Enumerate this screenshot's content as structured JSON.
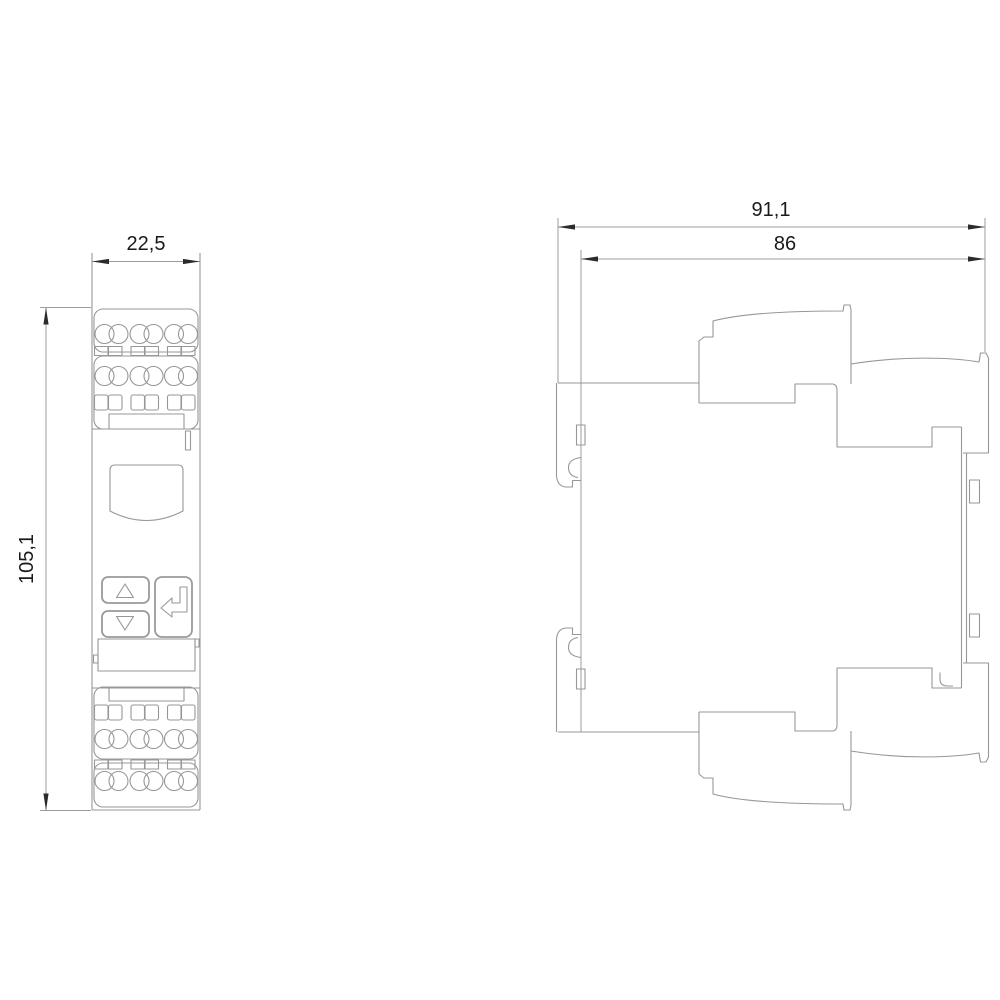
{
  "drawing": {
    "type": "technical-dimension-drawing",
    "background": "#ffffff"
  },
  "dimensions": {
    "front_width": "22,5",
    "front_height": "105,1",
    "side_depth_total": "91,1",
    "side_depth_body": "86"
  },
  "views": [
    {
      "id": "front-view",
      "dimension_labels": [
        "22,5",
        "105,1"
      ]
    },
    {
      "id": "side-view",
      "dimension_labels": [
        "91,1",
        "86"
      ]
    }
  ],
  "icons": [
    {
      "name": "up-arrow-icon",
      "glyph": "△"
    },
    {
      "name": "down-arrow-icon",
      "glyph": "▽"
    },
    {
      "name": "enter-arrow-icon",
      "glyph": "⏎"
    }
  ],
  "colors": {
    "line": "#979797",
    "arrow": "#2b2b2b",
    "dimension_text": "#1a1a1a",
    "background": "#ffffff"
  }
}
